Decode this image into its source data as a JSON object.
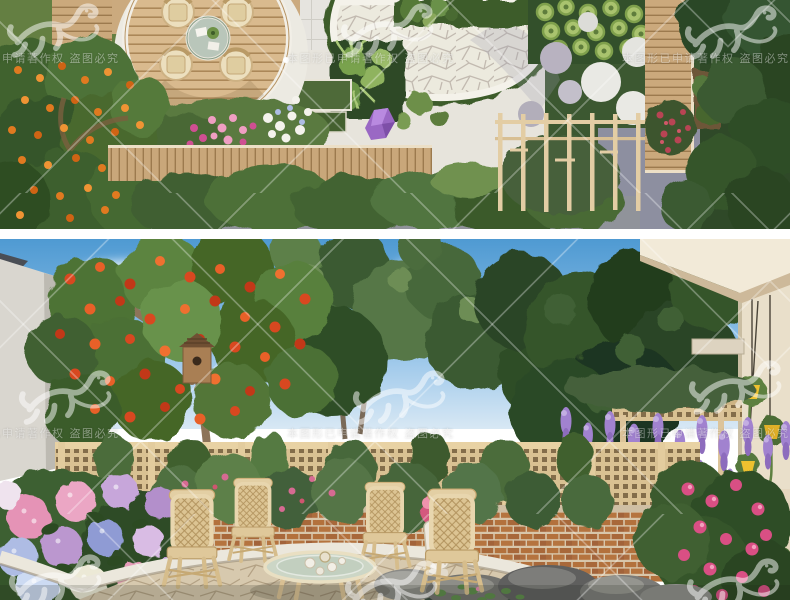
{
  "page": {
    "background": "#ffffff",
    "gap_color": "#ffffff"
  },
  "gallery": {
    "images": [
      {
        "name": "garden-aerial-plan-render"
      },
      {
        "name": "garden-courtyard-render"
      }
    ]
  },
  "watermark": {
    "text": "本图形已申请著作权 盗图必究",
    "text_color": "rgba(255,255,255,0.42)",
    "line_color": "rgba(255,255,255,0.30)",
    "logo": "dragon-seal"
  },
  "palette": {
    "sky_blue": "#5a9fd4",
    "foliage_dark": "#2f4d28",
    "foliage_green": "#4c7034",
    "foliage_light": "#6d8d55",
    "deck_wood": "#d7b88e",
    "walkway_wood": "#c9a77a",
    "lattice_beige": "#d9c192",
    "brick_red": "#b3713c",
    "flagstone_white": "#eceade",
    "path_grey": "#8d8fa0",
    "fruit_orange": "#e07a20",
    "fruit_red": "#d84820",
    "hydrangea_pink": "#e593b6",
    "hydrangea_purple": "#b38fcb",
    "hydrangea_blue": "#8f9bd4",
    "wisteria_purple": "#9a7ec8",
    "rose_pink": "#d94f84",
    "rattan_tan": "#dcc493",
    "pot_yellow": "#eec12f",
    "crystal_purple": "#9a68c4"
  }
}
